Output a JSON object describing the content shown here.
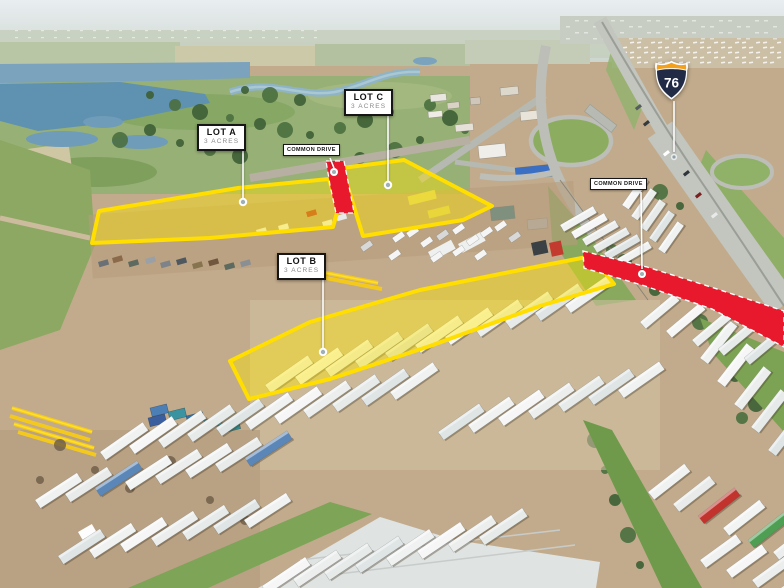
{
  "annotations": {
    "lots": [
      {
        "name": "LOT A",
        "acreage": "3 ACRES"
      },
      {
        "name": "LOT B",
        "acreage": "3 ACRES"
      },
      {
        "name": "LOT C",
        "acreage": "3 ACRES"
      }
    ],
    "road_labels": [
      {
        "name": "COMMON DRIVE"
      },
      {
        "name": "COMMON DRIVE"
      }
    ],
    "interstate_shield": {
      "number": "76"
    }
  },
  "colors": {
    "lot_highlight_fill": "#FFE400",
    "lot_highlight_border": "#FFDE00",
    "road_highlight_red": "#E8192C",
    "label_background": "#FFFFFF",
    "label_border": "#161616",
    "label_text": "#141414",
    "label_subtext": "#8A8A8A",
    "leader_line": "#FFFFFF",
    "shield_body": "#222B46",
    "shield_crest": "#F3A11C",
    "shield_number": "#FFFFFF"
  }
}
